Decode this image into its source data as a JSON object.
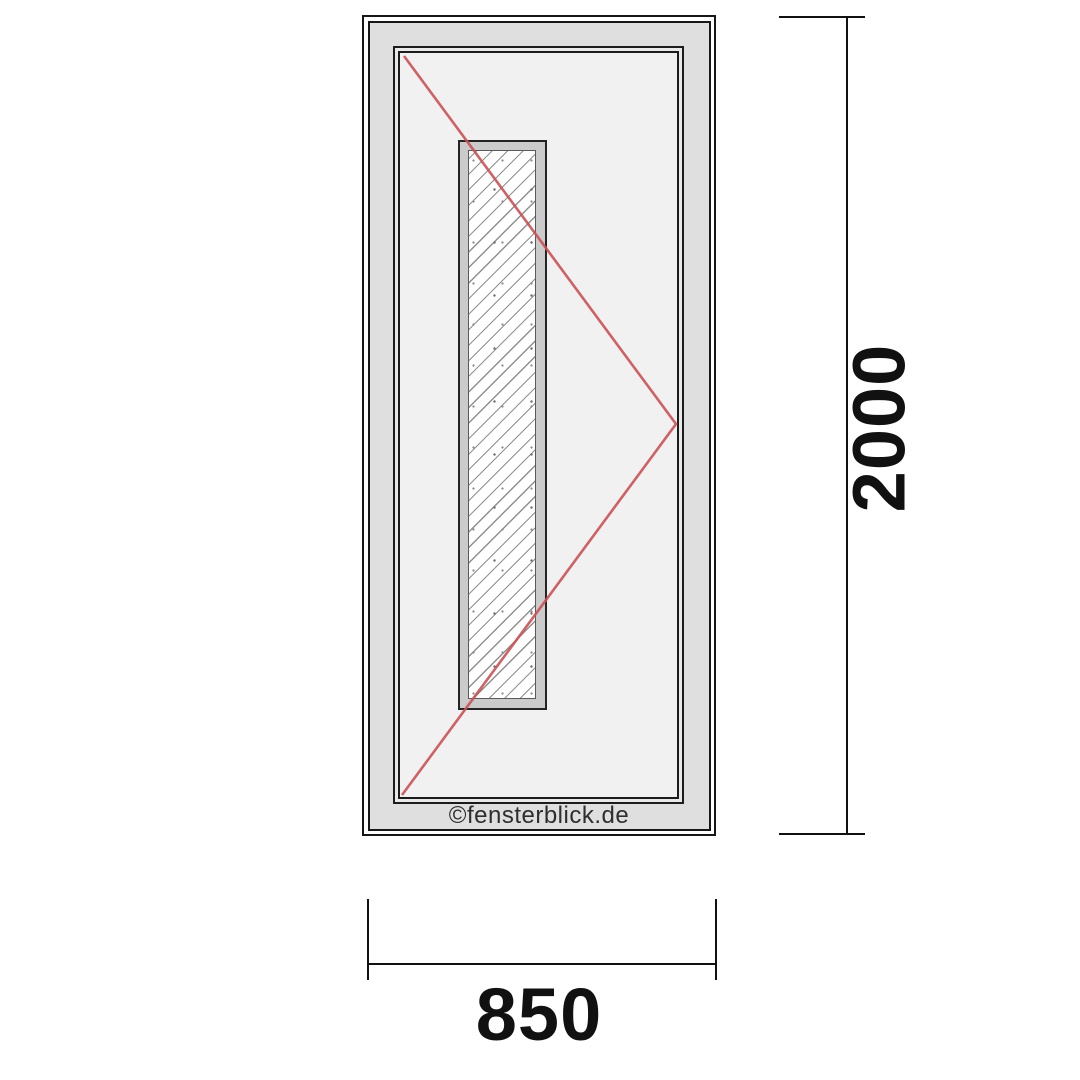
{
  "diagram": {
    "type": "door-elevation-technical-drawing",
    "watermark": "©fensterblick.de",
    "height_dimension": {
      "value": "2000"
    },
    "width_dimension": {
      "value": "850"
    },
    "colors": {
      "outline": "#171717",
      "frame_fill": "#dfdfdf",
      "leaf_fill": "#f1f1f1",
      "leaf_edge_highlight": "#e9e9e9",
      "glazing_bead_fill": "#cbcbcb",
      "glass_hatch": "#8f8f8f",
      "opening_direction_line": "#ca5153",
      "dimension_line": "#111111",
      "watermark_text": "#2e2e2e",
      "background": "#ffffff"
    }
  }
}
